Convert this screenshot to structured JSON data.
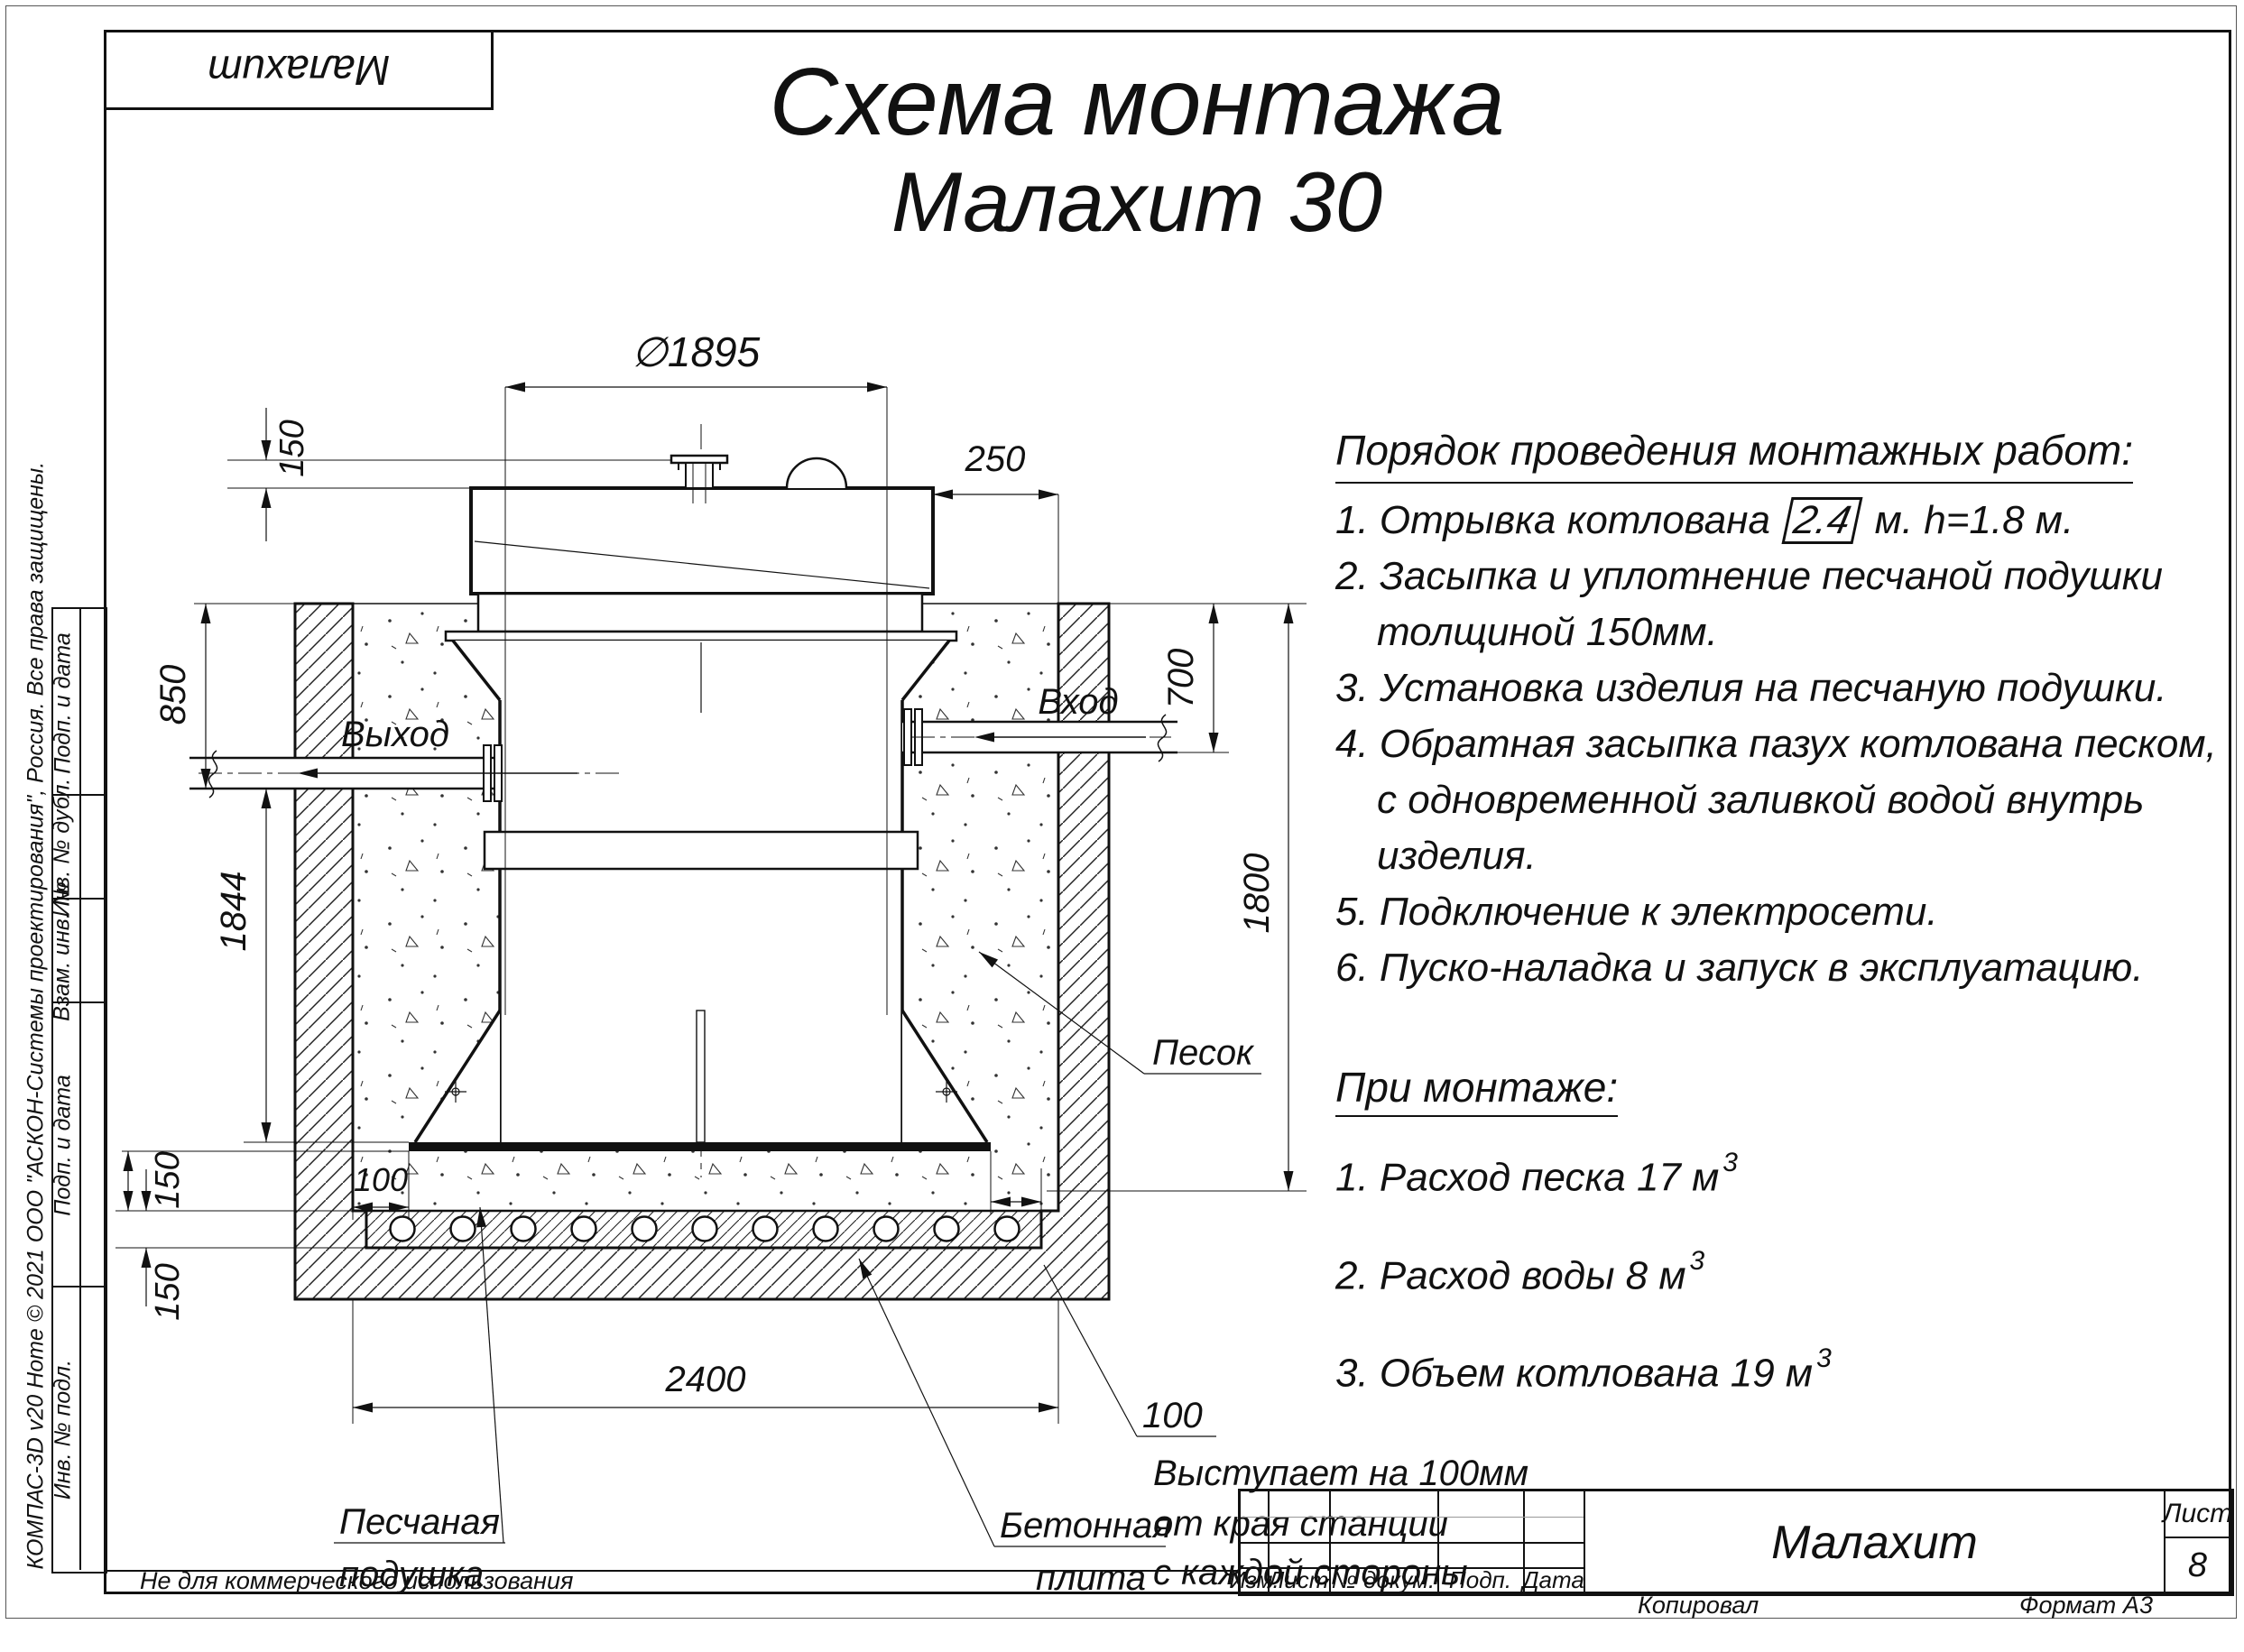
{
  "sheet": {
    "disclaimer": "Не для коммерческого использования",
    "watermark": "КОМПАС-3D v20 Home © 2021 ООО \"АСКОН-Системы проектирования\", Россия. Все права защищены.",
    "copied_label": "Копировал",
    "format_label": "Формат",
    "format_value": "А3"
  },
  "corner": {
    "product": "Малахит"
  },
  "title": {
    "line1": "Схема монтажа",
    "line2": "Малахит 30"
  },
  "procedure": {
    "heading": "Порядок проведения монтажных работ:",
    "item1_pre": "1. Отрывка котлована",
    "item1_box": "2.4",
    "item1_post": "м. h=1.8 м.",
    "lines": [
      "2. Засыпка и уплотнение песчаной подушки",
      "толщиной 150мм.",
      "3. Установка изделия на песчаную подушки.",
      "4. Обратная засыпка пазух котлована песком,",
      "с одновременной заливкой водой внутрь",
      "изделия.",
      "5. Подключение к электросети.",
      "6. Пуско-наладка и запуск в эксплуатацию."
    ]
  },
  "montage": {
    "heading": "При монтаже:",
    "sup": "3",
    "items": [
      "1. Расход песка 17 м",
      "2. Расход воды 8 м",
      "3. Объем котлована 19 м"
    ]
  },
  "drawing": {
    "dims": {
      "diameter": "∅1895",
      "edge_top": "250",
      "lid": "150",
      "outlet": "850",
      "body": "1844",
      "pad": "150",
      "slab": "150",
      "inlet": "700",
      "depth": "1800",
      "width": "2400",
      "overhang_left": "100",
      "overhang_right": "100"
    },
    "labels": {
      "inlet": "Вход",
      "outlet": "Выход",
      "sand": "Песок",
      "pad1": "Песчаная",
      "pad2": "подушка",
      "slab1": "Бетонная",
      "slab2": "плита",
      "note1": "Выступает на 100мм",
      "note2": "от края станции",
      "note3": "с каждой стороны"
    }
  },
  "stamp": {
    "cols": [
      "Изм.",
      "Лист",
      "№ докум.",
      "Подп.",
      "Дата"
    ],
    "product": "Малахит",
    "sheet_label": "Лист",
    "sheet_number": "8"
  },
  "side": {
    "cells": [
      "Подп. и дата",
      "Инв. № дубл.",
      "Взам. инв. №",
      "Подп. и дата",
      "Инв. № подл."
    ]
  }
}
